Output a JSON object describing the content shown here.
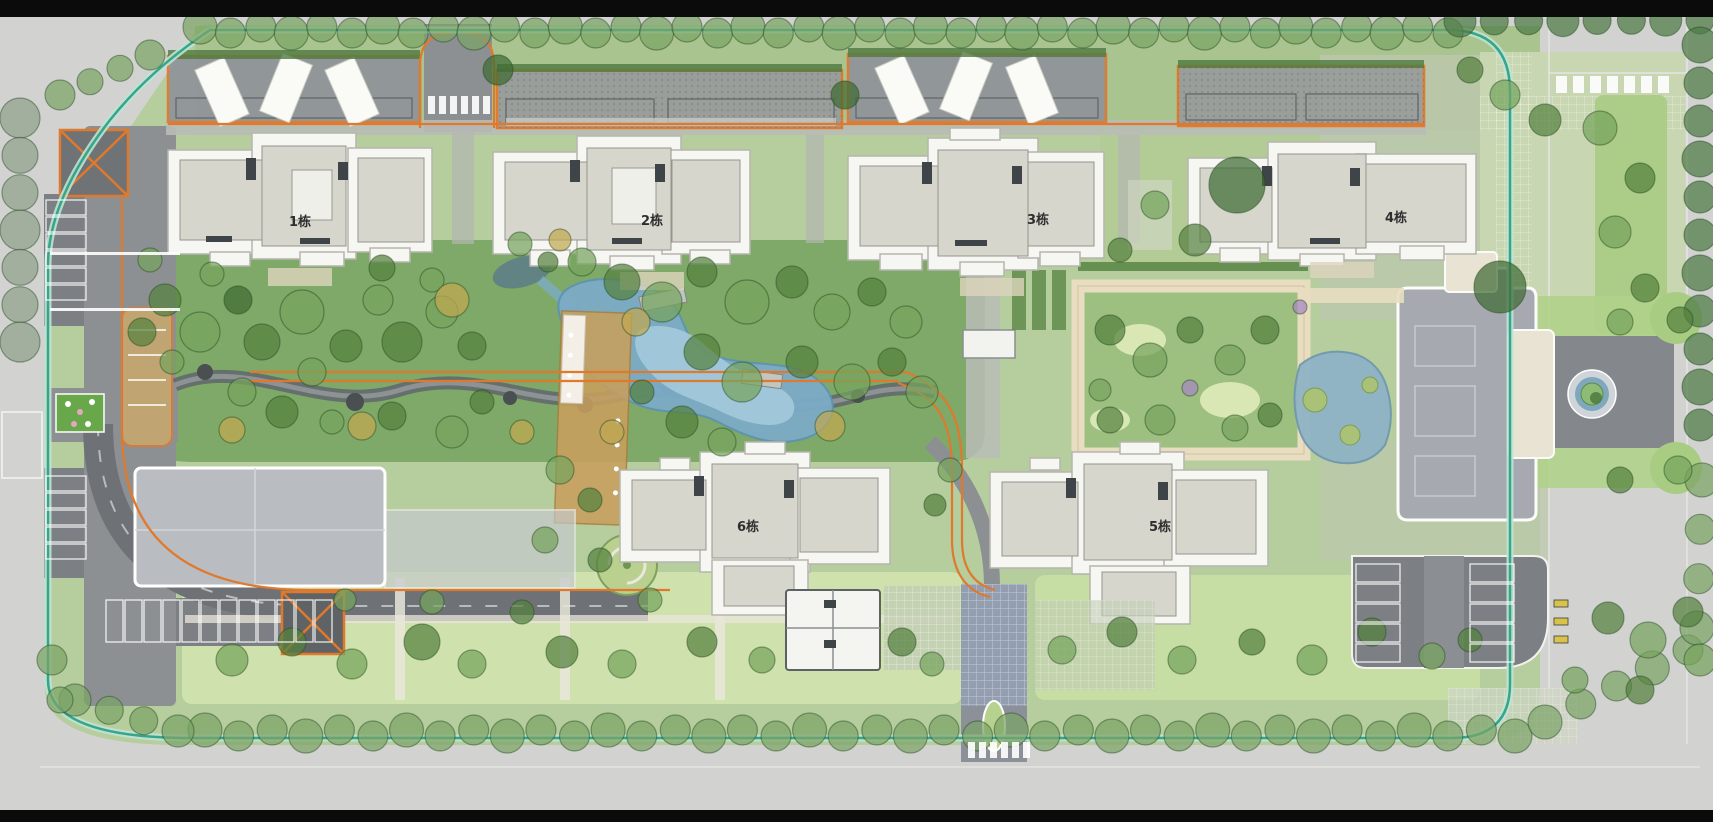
{
  "title": "residential-landscape-master-plan",
  "buildings": [
    {
      "id": "building-1",
      "label": "1栋"
    },
    {
      "id": "building-2",
      "label": "2栋"
    },
    {
      "id": "building-3",
      "label": "3栋"
    },
    {
      "id": "building-4",
      "label": "4栋"
    },
    {
      "id": "building-5",
      "label": "5栋"
    },
    {
      "id": "building-6",
      "label": "6栋"
    }
  ],
  "colors": {
    "surround_gray": "#d2d3d1",
    "frame_black": "#0b0b0b",
    "site_green": "#b6cd9e",
    "lawn_light": "#cfe2ad",
    "landscape_green": "#7ea968",
    "tree_green": "#76a35d",
    "water_blue": "#7cabc6",
    "road_gray": "#8d9093",
    "parking_dark": "#7c8084",
    "building_white": "#f6f6f2",
    "roof_gray": "#d6d6cd",
    "garage_outline_orange": "#e0792c",
    "deck_tan": "#c89f5e",
    "walkway_tan": "#e8ddc0",
    "boundary_teal": "#35a58c"
  },
  "decor": {
    "tree_rows": [
      {
        "x1": 200,
        "y1": 30,
        "x2": 1448,
        "y2": 30,
        "n": 42,
        "r": 15,
        "k": "row",
        "jy": 3
      },
      {
        "x1": 1460,
        "y1": 21,
        "x2": 1700,
        "y2": 20,
        "n": 8,
        "r": 14,
        "k": "dark"
      },
      {
        "x1": 1700,
        "y1": 45,
        "x2": 1700,
        "y2": 425,
        "n": 11,
        "r": 16,
        "k": "dark"
      },
      {
        "x1": 205,
        "y1": 733,
        "x2": 1515,
        "y2": 733,
        "n": 40,
        "r": 15,
        "k": "row",
        "jy": 3
      },
      {
        "x1": 75,
        "y1": 700,
        "x2": 178,
        "y2": 731,
        "n": 4,
        "r": 14,
        "k": "row"
      },
      {
        "x1": 52,
        "y1": 660,
        "x2": 60,
        "y2": 700,
        "n": 2,
        "r": 13,
        "k": "row"
      },
      {
        "x1": 20,
        "y1": 118,
        "x2": 20,
        "y2": 342,
        "n": 7,
        "r": 18,
        "k": "gray"
      },
      {
        "x1": 1545,
        "y1": 722,
        "x2": 1688,
        "y2": 650,
        "n": 5,
        "r": 15,
        "k": "row"
      },
      {
        "x1": 1697,
        "y1": 628,
        "x2": 1702,
        "y2": 480,
        "n": 4,
        "r": 15,
        "k": "row"
      },
      {
        "x1": 60,
        "y1": 95,
        "x2": 150,
        "y2": 55,
        "n": 4,
        "r": 13,
        "k": "row"
      }
    ],
    "trees": [
      [
        165,
        300,
        16,
        "d"
      ],
      [
        200,
        332,
        20,
        "g"
      ],
      [
        238,
        300,
        14,
        "e"
      ],
      [
        212,
        274,
        12,
        "g"
      ],
      [
        262,
        342,
        18,
        "d"
      ],
      [
        302,
        312,
        22,
        "g"
      ],
      [
        346,
        346,
        16,
        "d"
      ],
      [
        312,
        372,
        14,
        "g"
      ],
      [
        378,
        300,
        15,
        "g"
      ],
      [
        402,
        342,
        20,
        "d"
      ],
      [
        442,
        312,
        16,
        "g"
      ],
      [
        472,
        346,
        14,
        "d"
      ],
      [
        432,
        280,
        12,
        "g"
      ],
      [
        382,
        268,
        13,
        "d"
      ],
      [
        582,
        262,
        14,
        "g"
      ],
      [
        622,
        282,
        18,
        "d"
      ],
      [
        662,
        302,
        20,
        "g"
      ],
      [
        702,
        272,
        15,
        "d"
      ],
      [
        747,
        302,
        22,
        "g"
      ],
      [
        792,
        282,
        16,
        "d"
      ],
      [
        832,
        312,
        18,
        "g"
      ],
      [
        872,
        292,
        14,
        "d"
      ],
      [
        906,
        322,
        16,
        "g"
      ],
      [
        702,
        352,
        18,
        "d"
      ],
      [
        742,
        382,
        20,
        "g"
      ],
      [
        802,
        362,
        16,
        "d"
      ],
      [
        852,
        382,
        18,
        "g"
      ],
      [
        892,
        362,
        14,
        "d"
      ],
      [
        922,
        392,
        16,
        "g"
      ],
      [
        682,
        422,
        16,
        "d"
      ],
      [
        722,
        442,
        14,
        "g"
      ],
      [
        642,
        392,
        12,
        "d"
      ],
      [
        242,
        392,
        14,
        "g"
      ],
      [
        282,
        412,
        16,
        "d"
      ],
      [
        332,
        422,
        12,
        "g"
      ],
      [
        392,
        416,
        14,
        "d"
      ],
      [
        452,
        432,
        16,
        "g"
      ],
      [
        482,
        402,
        12,
        "d"
      ],
      [
        172,
        362,
        12,
        "g"
      ],
      [
        142,
        332,
        14,
        "d"
      ],
      [
        520,
        244,
        12,
        "g"
      ],
      [
        548,
        262,
        10,
        "d"
      ],
      [
        452,
        300,
        17,
        "y"
      ],
      [
        362,
        426,
        14,
        "y"
      ],
      [
        522,
        432,
        12,
        "y"
      ],
      [
        636,
        322,
        14,
        "y"
      ],
      [
        830,
        426,
        15,
        "y"
      ],
      [
        232,
        430,
        13,
        "y"
      ],
      [
        612,
        432,
        12,
        "y"
      ],
      [
        560,
        240,
        11,
        "y"
      ],
      [
        232,
        660,
        16,
        "g"
      ],
      [
        292,
        642,
        14,
        "d"
      ],
      [
        352,
        664,
        15,
        "g"
      ],
      [
        422,
        642,
        18,
        "d"
      ],
      [
        472,
        664,
        14,
        "g"
      ],
      [
        562,
        652,
        16,
        "d"
      ],
      [
        622,
        664,
        14,
        "g"
      ],
      [
        702,
        642,
        15,
        "d"
      ],
      [
        762,
        660,
        13,
        "g"
      ],
      [
        902,
        642,
        14,
        "d"
      ],
      [
        932,
        664,
        12,
        "g"
      ],
      [
        432,
        602,
        12,
        "g"
      ],
      [
        522,
        612,
        12,
        "d"
      ],
      [
        345,
        600,
        11,
        "g"
      ],
      [
        650,
        600,
        12,
        "g"
      ],
      [
        1062,
        650,
        14,
        "g"
      ],
      [
        1122,
        632,
        15,
        "d"
      ],
      [
        1182,
        660,
        14,
        "g"
      ],
      [
        1252,
        642,
        13,
        "d"
      ],
      [
        1312,
        660,
        15,
        "g"
      ],
      [
        1372,
        632,
        14,
        "d"
      ],
      [
        1432,
        656,
        13,
        "g"
      ],
      [
        1470,
        640,
        12,
        "d"
      ],
      [
        1110,
        330,
        15,
        "d"
      ],
      [
        1150,
        360,
        17,
        "g"
      ],
      [
        1190,
        330,
        13,
        "d"
      ],
      [
        1230,
        360,
        15,
        "g"
      ],
      [
        1265,
        330,
        14,
        "d"
      ],
      [
        1160,
        420,
        15,
        "g"
      ],
      [
        1110,
        420,
        13,
        "d"
      ],
      [
        1235,
        428,
        13,
        "g"
      ],
      [
        1270,
        415,
        12,
        "d"
      ],
      [
        1100,
        390,
        11,
        "g"
      ],
      [
        1300,
        307,
        7,
        "p"
      ],
      [
        1190,
        388,
        8,
        "p"
      ],
      [
        1237,
        185,
        28,
        "e"
      ],
      [
        1195,
        240,
        16,
        "d"
      ],
      [
        1155,
        205,
        14,
        "g"
      ],
      [
        1120,
        250,
        12,
        "d"
      ],
      [
        1500,
        287,
        26,
        "e"
      ],
      [
        1545,
        120,
        16,
        "d"
      ],
      [
        1600,
        128,
        17,
        "g"
      ],
      [
        1640,
        178,
        15,
        "d"
      ],
      [
        1615,
        232,
        16,
        "g"
      ],
      [
        1645,
        288,
        14,
        "d"
      ],
      [
        1620,
        322,
        13,
        "g"
      ],
      [
        1680,
        320,
        13,
        "d"
      ],
      [
        1678,
        470,
        14,
        "g"
      ],
      [
        1620,
        480,
        13,
        "d"
      ],
      [
        1608,
        618,
        16,
        "d"
      ],
      [
        1648,
        640,
        18,
        "g"
      ],
      [
        1688,
        612,
        15,
        "d"
      ],
      [
        1700,
        660,
        16,
        "g"
      ],
      [
        1640,
        690,
        14,
        "d"
      ],
      [
        1575,
        680,
        13,
        "g"
      ],
      [
        1505,
        95,
        15,
        "g"
      ],
      [
        1470,
        70,
        13,
        "d"
      ],
      [
        560,
        470,
        14,
        "g"
      ],
      [
        590,
        500,
        12,
        "d"
      ],
      [
        545,
        540,
        13,
        "g"
      ],
      [
        600,
        560,
        12,
        "d"
      ],
      [
        950,
        470,
        12,
        "g"
      ],
      [
        935,
        505,
        11,
        "d"
      ],
      [
        150,
        260,
        12,
        "g"
      ],
      [
        498,
        70,
        15,
        "e"
      ],
      [
        845,
        95,
        14,
        "e"
      ]
    ],
    "stall_rows": [
      {
        "x": 46,
        "y": 200,
        "n": 6,
        "dx": 0,
        "dy": 17,
        "w": 40,
        "h": 15
      },
      {
        "x": 46,
        "y": 476,
        "n": 5,
        "dx": 0,
        "dy": 17,
        "w": 40,
        "h": 15
      },
      {
        "x": 106,
        "y": 600,
        "n": 12,
        "dx": 19,
        "dy": 0,
        "w": 17,
        "h": 42
      },
      {
        "x": 1356,
        "y": 564,
        "n": 5,
        "dx": 0,
        "dy": 20,
        "w": 44,
        "h": 18
      },
      {
        "x": 1470,
        "y": 564,
        "n": 5,
        "dx": 0,
        "dy": 20,
        "w": 44,
        "h": 18
      }
    ],
    "crosswalks": [
      {
        "x": 428,
        "y": 96,
        "n": 6,
        "dx": 11,
        "w": 7,
        "h": 18
      },
      {
        "x": 968,
        "y": 742,
        "n": 6,
        "dx": 11,
        "w": 7,
        "h": 16
      },
      {
        "x": 1556,
        "y": 76,
        "n": 7,
        "dx": 17,
        "w": 11,
        "h": 17
      },
      {
        "x": 50,
        "y": 252,
        "n": 1,
        "dx": 0,
        "w": 130,
        "h": 3
      },
      {
        "x": 50,
        "y": 308,
        "n": 1,
        "dx": 0,
        "w": 130,
        "h": 3
      }
    ]
  }
}
